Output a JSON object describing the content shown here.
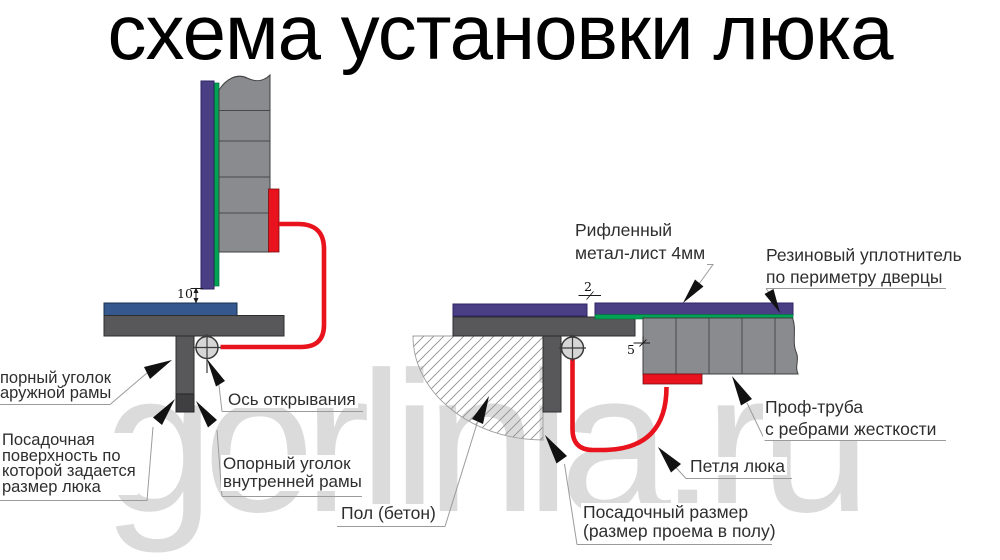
{
  "title": "схема установки люка",
  "watermark": "gorlinia.ru",
  "colors": {
    "sheet_purple": "#4a3f85",
    "seal_green": "#00a254",
    "frame_blue": "#35598e",
    "frame_dark": "#58585a",
    "frame_darker": "#3f3f42",
    "tube_gray": "#8a8b8e",
    "hinge_red": "#e8131c",
    "axis_circle_fill": "#d6d6d6",
    "watermark_gray": "#dbdbdb",
    "leader_gray": "#9b9b9b"
  },
  "left_view": {
    "labels": {
      "outer_angle_line1": "порный уголок",
      "outer_angle_line2": "аружной рамы",
      "seating_line1": "Посадочная",
      "seating_line2": "поверхность по",
      "seating_line3": "которой задается",
      "seating_line4": "размер люка",
      "axis": "Ось открывания",
      "inner_angle_line1": "Опорный уголок",
      "inner_angle_line2": "внутренней рамы"
    },
    "dim_gap": "10"
  },
  "right_view": {
    "labels": {
      "sheet_line1": "Рифленный",
      "sheet_line2": "метал-лист 4мм",
      "seal_line1": "Резиновый уплотнитель",
      "seal_line2": "по периметру дверцы",
      "tube_line1": "Проф-труба",
      "tube_line2": "с ребрами жесткости",
      "hinge": "Петля люка",
      "opening_line1": "Посадочный размер",
      "opening_line2": "(размер проема в полу)",
      "floor": "Пол (бетон)"
    },
    "dim_sheet": "2",
    "dim_offset": "5"
  }
}
